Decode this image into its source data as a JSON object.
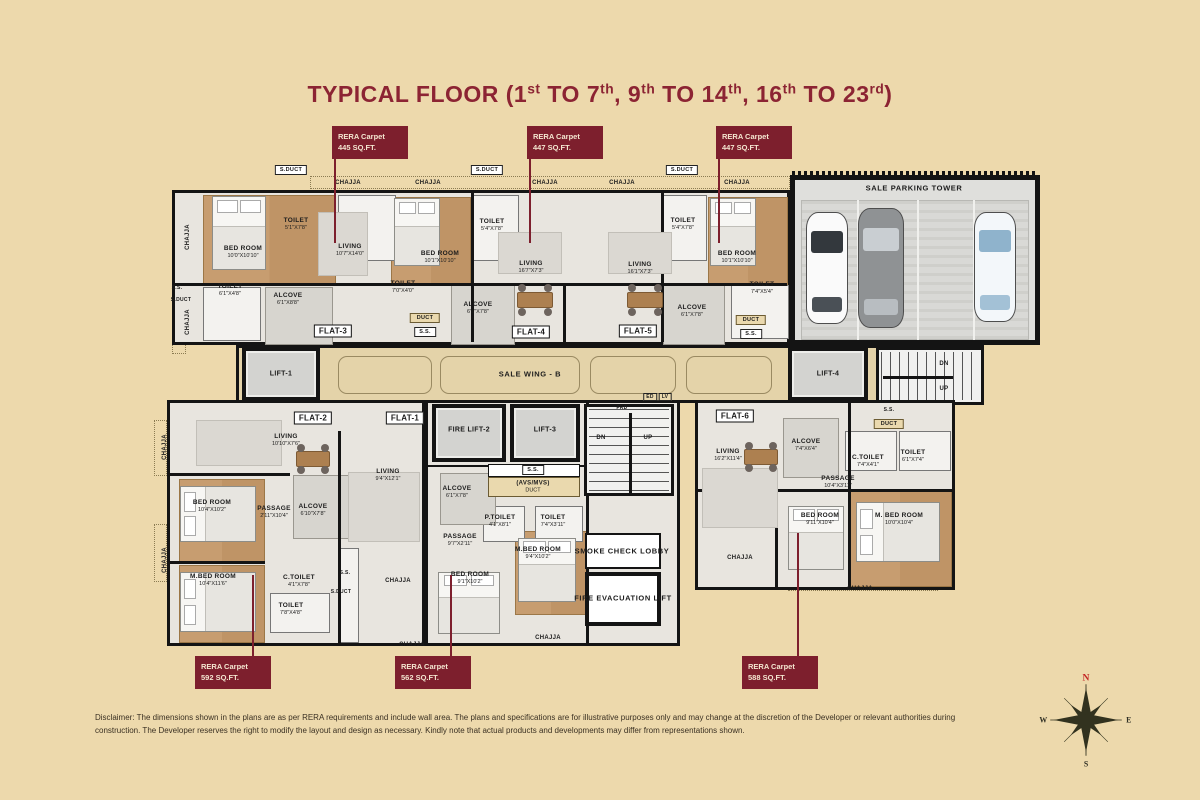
{
  "title": {
    "text": "TYPICAL FLOOR (1st TO 7th, 9th TO 14th, 16th TO 23rd)",
    "parts": [
      {
        "t": "TYPICAL FLOOR  (1"
      },
      {
        "t": "st",
        "sup": true
      },
      {
        "t": " TO 7"
      },
      {
        "t": "th",
        "sup": true
      },
      {
        "t": ", 9"
      },
      {
        "t": "th",
        "sup": true
      },
      {
        "t": " TO 14"
      },
      {
        "t": "th",
        "sup": true
      },
      {
        "t": ", 16"
      },
      {
        "t": "th",
        "sup": true
      },
      {
        "t": " TO 23"
      },
      {
        "t": "rd",
        "sup": true
      },
      {
        "t": ")"
      }
    ]
  },
  "rera_labels": [
    {
      "l1": "RERA Carpet",
      "l2": "445 SQ.FT.",
      "bx": 332,
      "by": 126,
      "lx": 334,
      "ly1": 158,
      "ly2": 243
    },
    {
      "l1": "RERA Carpet",
      "l2": "447 SQ.FT.",
      "bx": 527,
      "by": 126,
      "lx": 529,
      "ly1": 158,
      "ly2": 243
    },
    {
      "l1": "RERA Carpet",
      "l2": "447 SQ.FT.",
      "bx": 716,
      "by": 126,
      "lx": 718,
      "ly1": 158,
      "ly2": 243
    },
    {
      "l1": "RERA Carpet",
      "l2": "592 SQ.FT.",
      "bx": 195,
      "by": 656,
      "lx": 252,
      "ly1": 575,
      "ly2": 656
    },
    {
      "l1": "RERA Carpet",
      "l2": "562 SQ.FT.",
      "bx": 395,
      "by": 656,
      "lx": 450,
      "ly1": 575,
      "ly2": 656
    },
    {
      "l1": "RERA Carpet",
      "l2": "588 SQ.FT.",
      "bx": 742,
      "by": 656,
      "lx": 797,
      "ly1": 533,
      "ly2": 656
    }
  ],
  "labels": [
    {
      "cls": "whitebox",
      "t": "S.DUCT",
      "x": 291,
      "y": 170,
      "name": "sduct-label"
    },
    {
      "cls": "whitebox",
      "t": "S.DUCT",
      "x": 487,
      "y": 170,
      "name": "sduct-label"
    },
    {
      "cls": "whitebox",
      "t": "S.DUCT",
      "x": 682,
      "y": 170,
      "name": "sduct-label"
    },
    {
      "cls": "tiny",
      "t": "CHAJJA",
      "x": 348,
      "y": 183,
      "name": "chajja-label"
    },
    {
      "cls": "tiny",
      "t": "CHAJJA",
      "x": 428,
      "y": 183,
      "name": "chajja-label"
    },
    {
      "cls": "tiny",
      "t": "CHAJJA",
      "x": 545,
      "y": 183,
      "name": "chajja-label"
    },
    {
      "cls": "tiny",
      "t": "CHAJJA",
      "x": 622,
      "y": 183,
      "name": "chajja-label"
    },
    {
      "cls": "tiny",
      "t": "CHAJJA",
      "x": 737,
      "y": 183,
      "name": "chajja-label"
    },
    {
      "cls": "tiny",
      "t": "CHAJJA",
      "x": 188,
      "y": 237,
      "r": -90,
      "name": "chajja-label"
    },
    {
      "cls": "tiny",
      "t": "CHAJJA",
      "x": 188,
      "y": 322,
      "r": -90,
      "name": "chajja-label"
    },
    {
      "cls": "micro",
      "t": "S.S.",
      "x": 177,
      "y": 288,
      "name": "ss-label"
    },
    {
      "cls": "micro",
      "t": "S.DUCT",
      "x": 181,
      "y": 300,
      "name": "sduct-label"
    },
    {
      "cls": "room",
      "t": "BED ROOM",
      "d": "10'0\"X10'10\"",
      "x": 243,
      "y": 252
    },
    {
      "cls": "room",
      "t": "TOILET",
      "d": "5'1\"X7'8\"",
      "x": 296,
      "y": 224
    },
    {
      "cls": "room",
      "t": "LIVING",
      "d": "10'7\"X14'0\"",
      "x": 350,
      "y": 250
    },
    {
      "cls": "room",
      "t": "TOILET",
      "d": "6'1\"X4'8\"",
      "x": 230,
      "y": 290
    },
    {
      "cls": "room",
      "t": "ALCOVE",
      "d": "6'1\"X8'8\"",
      "x": 288,
      "y": 299
    },
    {
      "cls": "beigebox",
      "t": "DUCT",
      "x": 425,
      "y": 318,
      "name": "duct-label"
    },
    {
      "cls": "whitebox",
      "t": "S.S.",
      "x": 425,
      "y": 332,
      "name": "ss-label"
    },
    {
      "cls": "room",
      "t": "BED ROOM",
      "d": "10'1\"X10'10\"",
      "x": 440,
      "y": 257
    },
    {
      "cls": "room",
      "t": "TOILET",
      "d": "5'4\"X7'8\"",
      "x": 492,
      "y": 225
    },
    {
      "cls": "room",
      "t": "LIVING",
      "d": "16'7\"X7'3\"",
      "x": 531,
      "y": 267
    },
    {
      "cls": "room",
      "t": "TOILET",
      "d": "7'0\"X4'0\"",
      "x": 403,
      "y": 287
    },
    {
      "cls": "room",
      "t": "ALCOVE",
      "d": "6'1\"X7'8\"",
      "x": 478,
      "y": 308
    },
    {
      "cls": "room",
      "t": "LIVING",
      "d": "16'1\"X7'3\"",
      "x": 640,
      "y": 268
    },
    {
      "cls": "room",
      "t": "BED ROOM",
      "d": "10'1\"X10'10\"",
      "x": 737,
      "y": 257
    },
    {
      "cls": "room",
      "t": "TOILET",
      "d": "5'4\"X7'8\"",
      "x": 683,
      "y": 224
    },
    {
      "cls": "room",
      "t": "ALCOVE",
      "d": "6'1\"X7'8\"",
      "x": 692,
      "y": 311
    },
    {
      "cls": "room",
      "t": "TOILET",
      "d": "7'4\"X5'4\"",
      "x": 762,
      "y": 288
    },
    {
      "cls": "beigebox",
      "t": "DUCT",
      "x": 751,
      "y": 320,
      "name": "duct-label"
    },
    {
      "cls": "whitebox",
      "t": "S.S.",
      "x": 751,
      "y": 334,
      "name": "ss-label"
    },
    {
      "cls": "zone",
      "t": "SALE PARKING TOWER",
      "x": 914,
      "y": 188,
      "name": "parking-tower-label"
    },
    {
      "cls": "tiny",
      "t": "DN",
      "x": 944,
      "y": 364,
      "name": "stairs-dn-label"
    },
    {
      "cls": "tiny",
      "t": "UP",
      "x": 944,
      "y": 389,
      "name": "stairs-up-label"
    },
    {
      "cls": "micro",
      "t": "S.S.",
      "x": 889,
      "y": 410,
      "name": "ss-label"
    },
    {
      "cls": "beigebox",
      "t": "DUCT",
      "x": 889,
      "y": 424,
      "name": "duct-label"
    },
    {
      "cls": "lift",
      "t": "LIFT-1",
      "x": 281,
      "y": 374,
      "name": "lift-1-label"
    },
    {
      "cls": "zone",
      "t": "SALE WING - B",
      "x": 530,
      "y": 374,
      "name": "wing-label"
    },
    {
      "cls": "lift",
      "t": "LIFT-4",
      "x": 828,
      "y": 374,
      "name": "lift-4-label"
    },
    {
      "cls": "edlv",
      "t": "ED",
      "x": 650,
      "y": 397,
      "name": "ed-label"
    },
    {
      "cls": "edlv",
      "t": "LV",
      "x": 665,
      "y": 397,
      "name": "lv-label"
    },
    {
      "cls": "micro",
      "t": "FRD",
      "x": 622,
      "y": 408,
      "name": "frd-label"
    },
    {
      "cls": "lift",
      "t": "FIRE LIFT-2",
      "x": 469,
      "y": 430,
      "name": "fire-lift-2-label"
    },
    {
      "cls": "lift",
      "t": "LIFT-3",
      "x": 545,
      "y": 430,
      "name": "lift-3-label"
    },
    {
      "cls": "whitebox",
      "t": "S.S.",
      "x": 533,
      "y": 470,
      "name": "ss-label"
    },
    {
      "cls": "tiny",
      "t": "(AVS/MVS)",
      "d": "DUCT",
      "x": 533,
      "y": 487,
      "name": "avs-mvs-duct-label"
    },
    {
      "cls": "room",
      "t": "ALCOVE",
      "d": "6'1\"X7'8\"",
      "x": 457,
      "y": 492
    },
    {
      "cls": "room",
      "t": "P.TOILET",
      "d": "4'1\"X8'1\"",
      "x": 500,
      "y": 521
    },
    {
      "cls": "room",
      "t": "TOILET",
      "d": "7'4\"X3'11\"",
      "x": 553,
      "y": 521
    },
    {
      "cls": "room",
      "t": "PASSAGE",
      "d": "9'7\"X2'11\"",
      "x": 460,
      "y": 540
    },
    {
      "cls": "room",
      "t": "M.BED ROOM",
      "d": "9'4\"X10'2\"",
      "x": 538,
      "y": 553
    },
    {
      "cls": "tiny",
      "t": "DN",
      "x": 601,
      "y": 438,
      "name": "stairs-dn-label"
    },
    {
      "cls": "tiny",
      "t": "UP",
      "x": 648,
      "y": 438,
      "name": "stairs-up-label"
    },
    {
      "cls": "zone",
      "t": "SMOKE CHECK LOBBY",
      "x": 622,
      "y": 551,
      "name": "smoke-lobby-label"
    },
    {
      "cls": "zone",
      "t": "FIRE EVACUATION LIFT",
      "x": 623,
      "y": 598,
      "name": "fire-evac-lift-label"
    },
    {
      "cls": "room",
      "t": "LIVING",
      "d": "10'10\"X7'6\"",
      "x": 286,
      "y": 440
    },
    {
      "cls": "room",
      "t": "BED ROOM",
      "d": "10'4\"X10'2\"",
      "x": 212,
      "y": 506
    },
    {
      "cls": "room",
      "t": "PASSAGE",
      "d": "2'11\"X10'4\"",
      "x": 274,
      "y": 512
    },
    {
      "cls": "room",
      "t": "ALCOVE",
      "d": "6'10\"X7'8\"",
      "x": 313,
      "y": 510
    },
    {
      "cls": "room",
      "t": "M.BED ROOM",
      "d": "10'4\"X11'6\"",
      "x": 213,
      "y": 580
    },
    {
      "cls": "room",
      "t": "C.TOILET",
      "d": "4'1\"X7'8\"",
      "x": 299,
      "y": 581
    },
    {
      "cls": "room",
      "t": "TOILET",
      "d": "7'8\"X4'8\"",
      "x": 291,
      "y": 609
    },
    {
      "cls": "micro",
      "t": "S.S.",
      "x": 345,
      "y": 573,
      "name": "ss-label"
    },
    {
      "cls": "micro",
      "t": "S.DUCT",
      "x": 341,
      "y": 592,
      "name": "sduct-label"
    },
    {
      "cls": "tiny",
      "t": "CHAJJA",
      "x": 165,
      "y": 447,
      "r": -90,
      "name": "chajja-label"
    },
    {
      "cls": "tiny",
      "t": "CHAJJA",
      "x": 165,
      "y": 560,
      "r": -90,
      "name": "chajja-label"
    },
    {
      "cls": "tiny",
      "t": "CHAJJA",
      "x": 398,
      "y": 581,
      "name": "chajja-label"
    },
    {
      "cls": "room",
      "t": "LIVING",
      "d": "9'4\"X12'1\"",
      "x": 388,
      "y": 475
    },
    {
      "cls": "room",
      "t": "BED ROOM",
      "d": "9'1\"X10'2\"",
      "x": 470,
      "y": 578
    },
    {
      "cls": "tiny",
      "t": "CHAJJA",
      "x": 412,
      "y": 645,
      "name": "chajja-label"
    },
    {
      "cls": "tiny",
      "t": "CHAJJA",
      "x": 548,
      "y": 638,
      "name": "chajja-label"
    },
    {
      "cls": "room",
      "t": "LIVING",
      "d": "16'2\"X11'4\"",
      "x": 728,
      "y": 455
    },
    {
      "cls": "room",
      "t": "ALCOVE",
      "d": "7'4\"X6'4\"",
      "x": 806,
      "y": 445
    },
    {
      "cls": "room",
      "t": "C.TOILET",
      "d": "7'4\"X4'1\"",
      "x": 868,
      "y": 461
    },
    {
      "cls": "room",
      "t": "TOILET",
      "d": "6'1\"X7'4\"",
      "x": 913,
      "y": 456
    },
    {
      "cls": "room",
      "t": "PASSAGE",
      "d": "10'4\"X3'11\"",
      "x": 838,
      "y": 482
    },
    {
      "cls": "room",
      "t": "BED ROOM",
      "d": "9'11\"X10'4\"",
      "x": 820,
      "y": 519
    },
    {
      "cls": "room",
      "t": "M. BED ROOM",
      "d": "10'0\"X10'4\"",
      "x": 899,
      "y": 519
    },
    {
      "cls": "tiny",
      "t": "CHAJJA",
      "x": 740,
      "y": 558,
      "name": "chajja-label"
    },
    {
      "cls": "tiny",
      "t": "CHAJJA",
      "x": 860,
      "y": 589,
      "name": "chajja-label"
    },
    {
      "cls": "tag",
      "t": "FLAT-3",
      "x": 333,
      "y": 331,
      "name": "flat-3-tag"
    },
    {
      "cls": "tag",
      "t": "FLAT-4",
      "x": 531,
      "y": 332,
      "name": "flat-4-tag"
    },
    {
      "cls": "tag",
      "t": "FLAT-5",
      "x": 638,
      "y": 331,
      "name": "flat-5-tag"
    },
    {
      "cls": "tag",
      "t": "FLAT-2",
      "x": 313,
      "y": 418,
      "name": "flat-2-tag"
    },
    {
      "cls": "tag",
      "t": "FLAT-1",
      "x": 405,
      "y": 418,
      "name": "flat-1-tag"
    },
    {
      "cls": "tag",
      "t": "FLAT-6",
      "x": 735,
      "y": 416,
      "name": "flat-6-tag"
    }
  ],
  "compass": {
    "n": "N",
    "s": "S",
    "e": "E",
    "w": "W"
  },
  "disclaimer": "Disclaimer: The dimensions shown in the plans are as per RERA requirements and include wall area. The plans and specifications are for illustrative purposes only and may change at the discretion of the Developer or relevant authorities during construction. The Developer reserves the right to modify the layout and design as necessary. Kindly note that actual products and developments may differ from representations shown."
}
